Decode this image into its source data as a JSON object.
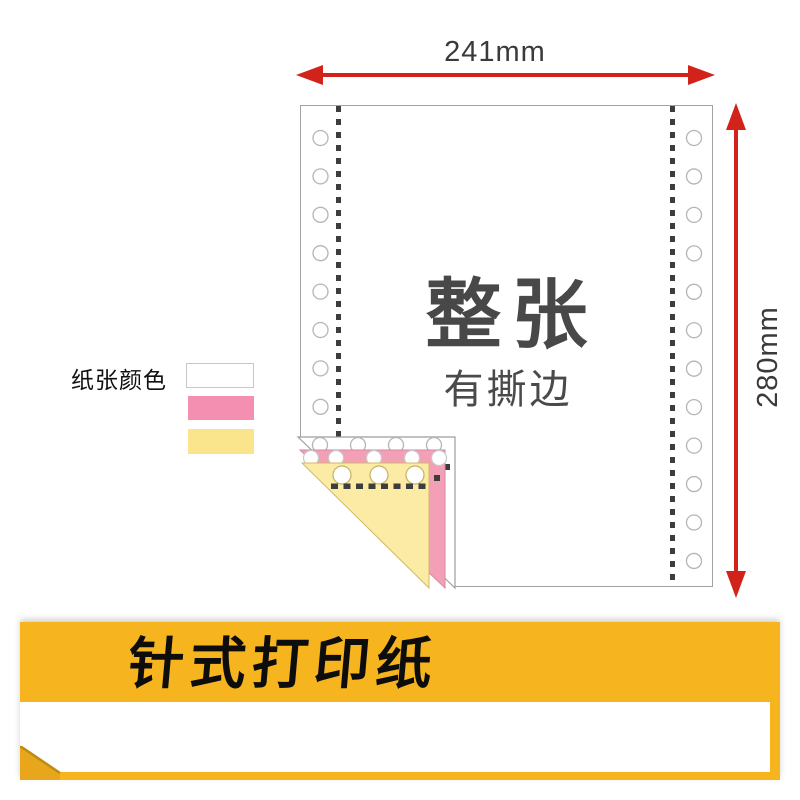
{
  "diagram": {
    "width_label": "241mm",
    "height_label": "280mm",
    "sheet_title": "整张",
    "sheet_subtitle": "有撕边"
  },
  "legend": {
    "title": "纸张颜色",
    "swatches": [
      {
        "name": "white-ply",
        "color_hex": "#ffffff",
        "style": "background:#ffffff;border:1px solid #c8c8c8"
      },
      {
        "name": "pink-ply",
        "color_hex": "#f58fb1",
        "style": "background:#f58fb1"
      },
      {
        "name": "yellow-ply",
        "color_hex": "#fae48c",
        "style": "background:#fae48c"
      }
    ]
  },
  "banner": {
    "title": "针式打印纸",
    "background_hex": "#f6b41f"
  },
  "colors": {
    "arrow_red": "#d2231a",
    "fold_pink": "#f3a0b7",
    "fold_yellow": "#fbeba4",
    "dimension_text": "#3a3a3a",
    "sheet_text": "#484848"
  },
  "holes": {
    "left_count": 8,
    "right_count": 12
  }
}
